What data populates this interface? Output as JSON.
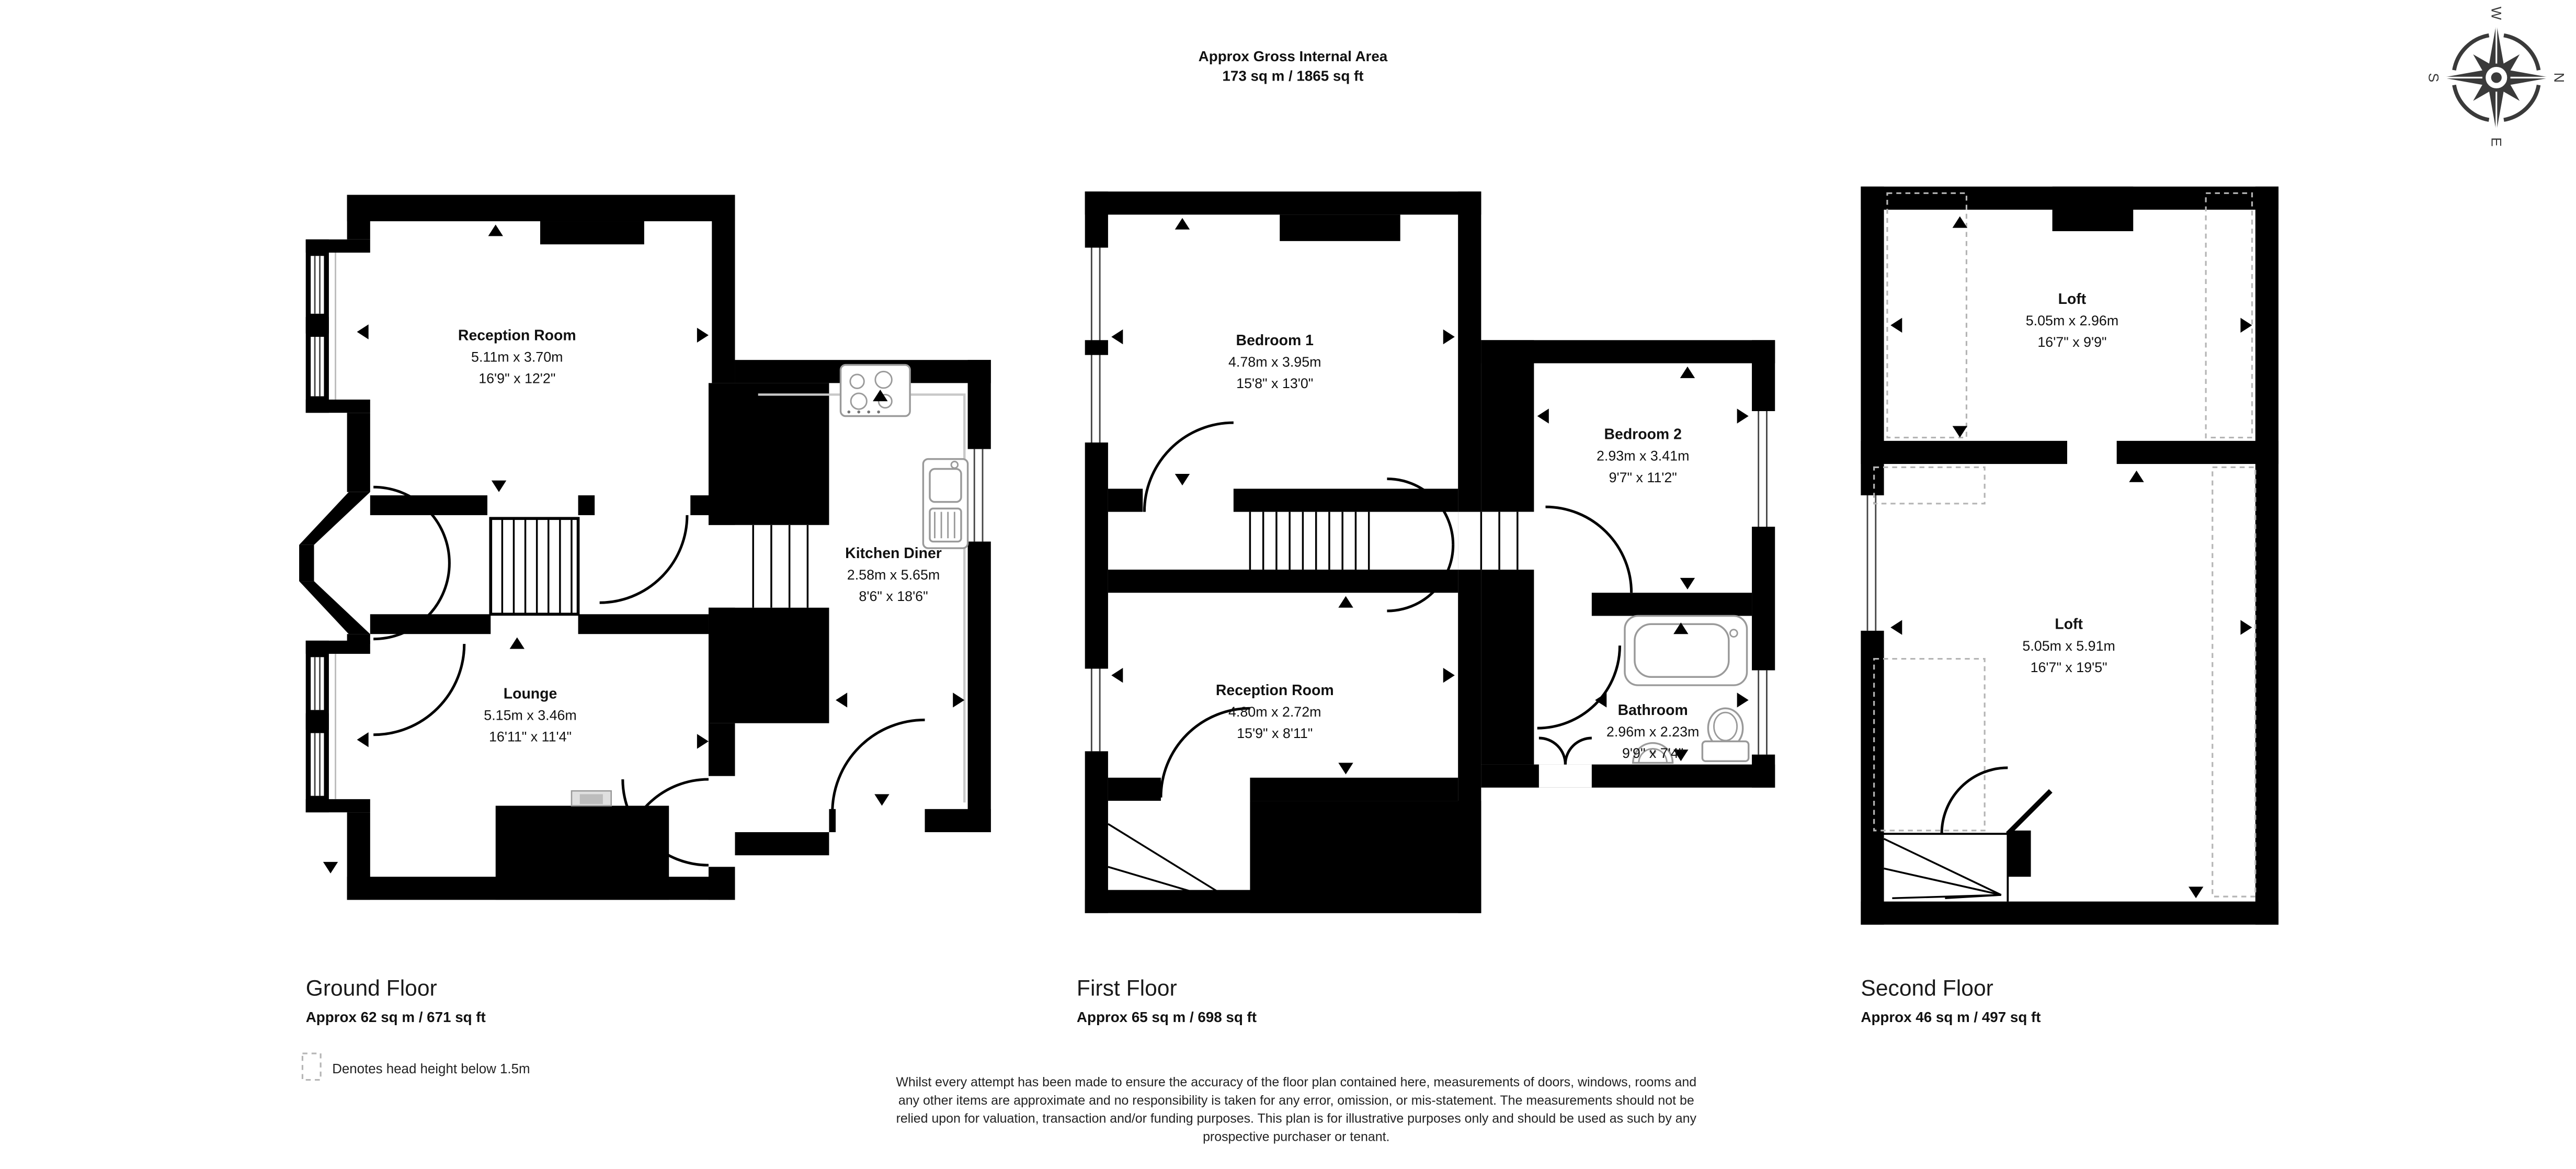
{
  "header": {
    "title_line1": "Approx Gross Internal Area",
    "title_line2": "173 sq m / 1865 sq ft"
  },
  "compass": {
    "n": "N",
    "e": "E",
    "s": "S",
    "w": "W"
  },
  "floors": [
    {
      "caption": "Ground Floor",
      "area": "Approx 62 sq m / 671 sq ft",
      "rooms": [
        {
          "name": "Reception Room",
          "metric": "5.11m x 3.70m",
          "imperial": "16'9\" x 12'2\""
        },
        {
          "name": "Lounge",
          "metric": "5.15m x 3.46m",
          "imperial": "16'11\" x 11'4\""
        },
        {
          "name": "Kitchen Diner",
          "metric": "2.58m x 5.65m",
          "imperial": "8'6\" x 18'6\""
        }
      ]
    },
    {
      "caption": "First Floor",
      "area": "Approx 65 sq m / 698 sq ft",
      "rooms": [
        {
          "name": "Bedroom 1",
          "metric": "4.78m x 3.95m",
          "imperial": "15'8\" x 13'0\""
        },
        {
          "name": "Bedroom 2",
          "metric": "2.93m x 3.41m",
          "imperial": "9'7\" x 11'2\""
        },
        {
          "name": "Reception Room",
          "metric": "4.80m x 2.72m",
          "imperial": "15'9\" x 8'11\""
        },
        {
          "name": "Bathroom",
          "metric": "2.96m x 2.23m",
          "imperial": "9'9\" x 7'4\""
        }
      ]
    },
    {
      "caption": "Second Floor",
      "area": "Approx 46 sq m / 497 sq ft",
      "rooms": [
        {
          "name": "Loft",
          "metric": "5.05m x 2.96m",
          "imperial": "16'7\" x 9'9\""
        },
        {
          "name": "Loft",
          "metric": "5.05m x 5.91m",
          "imperial": "16'7\" x 19'5\""
        }
      ]
    }
  ],
  "legend": {
    "text": "Denotes head height below 1.5m"
  },
  "disclaimer": {
    "lines": [
      "Whilst every attempt has been made to ensure the accuracy of the floor plan contained here, measurements of doors, windows, rooms and",
      "any other items are approximate and no responsibility is taken for any error, omission, or mis-statement. The measurements should not be",
      "relied upon for valuation, transaction and/or funding purposes. This plan is for illustrative purposes only and should be used as such by any",
      "prospective purchaser or tenant."
    ]
  },
  "colors": {
    "wall": "#000000",
    "fixture": "#9a9a9a",
    "head_height_dash": "#b5b5b5",
    "compass": "#3a3a3a",
    "background": "#ffffff"
  }
}
